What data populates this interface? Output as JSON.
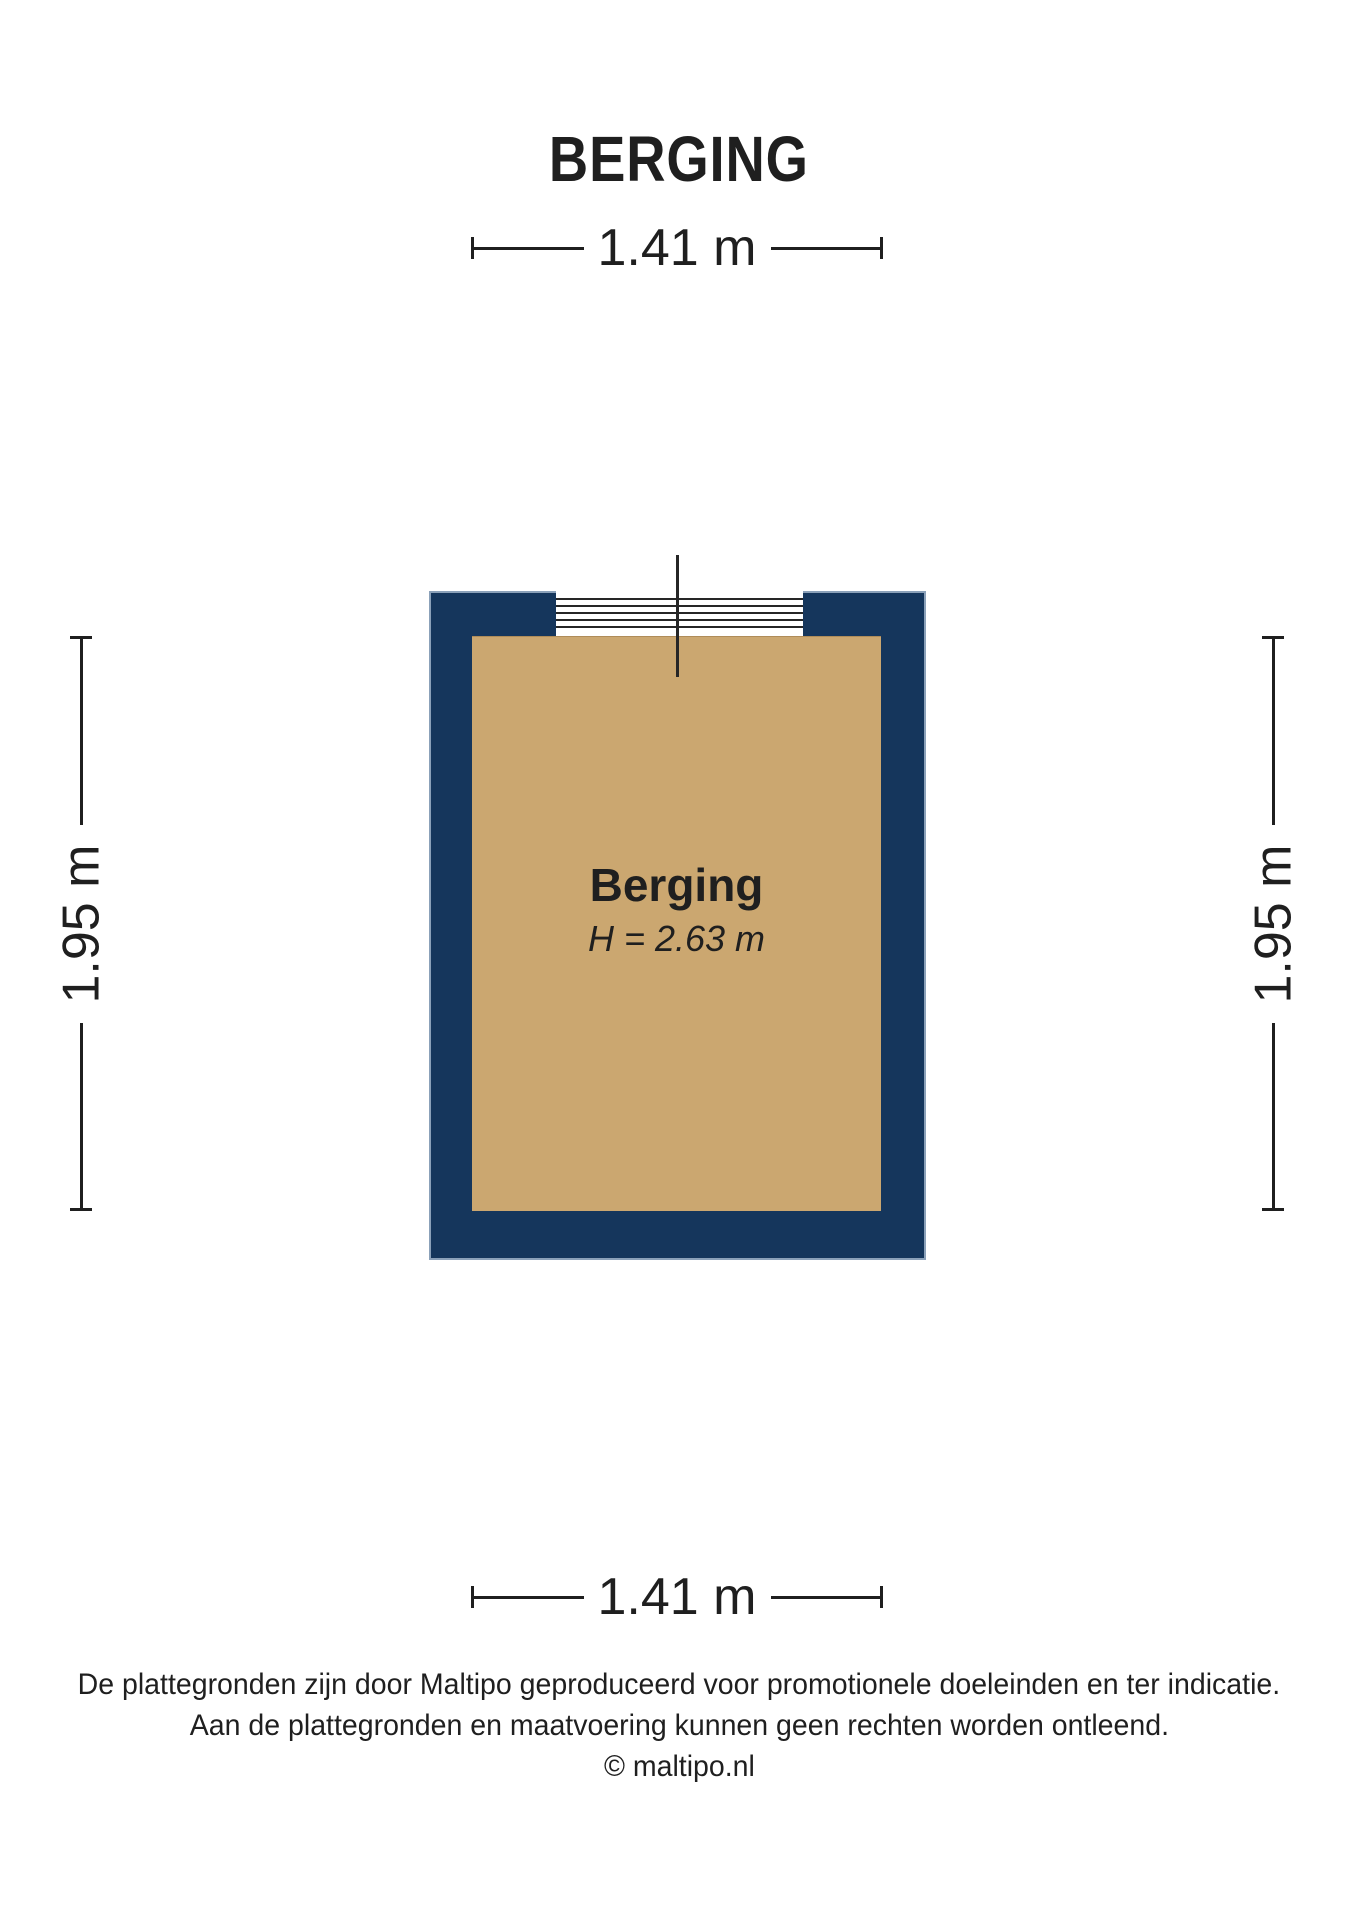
{
  "title": "BERGING",
  "floorplan": {
    "room": {
      "name": "Berging",
      "height_label": "H = 2.63 m"
    },
    "dimensions": {
      "top": "1.41 m",
      "bottom": "1.41 m",
      "left": "1.95 m",
      "right": "1.95 m"
    },
    "colors": {
      "wall": "#15365c",
      "wall_outline": "#8ba1b9",
      "floor": "#cba770",
      "dimension_lines": "#1f1f1f",
      "background": "#ffffff"
    }
  },
  "footer": {
    "line1": "De plattegronden zijn door Maltipo geproduceerd voor promotionele doeleinden en ter indicatie.",
    "line2": "Aan de plattegronden en maatvoering kunnen geen rechten worden ontleend.",
    "line3": "© maltipo.nl"
  }
}
